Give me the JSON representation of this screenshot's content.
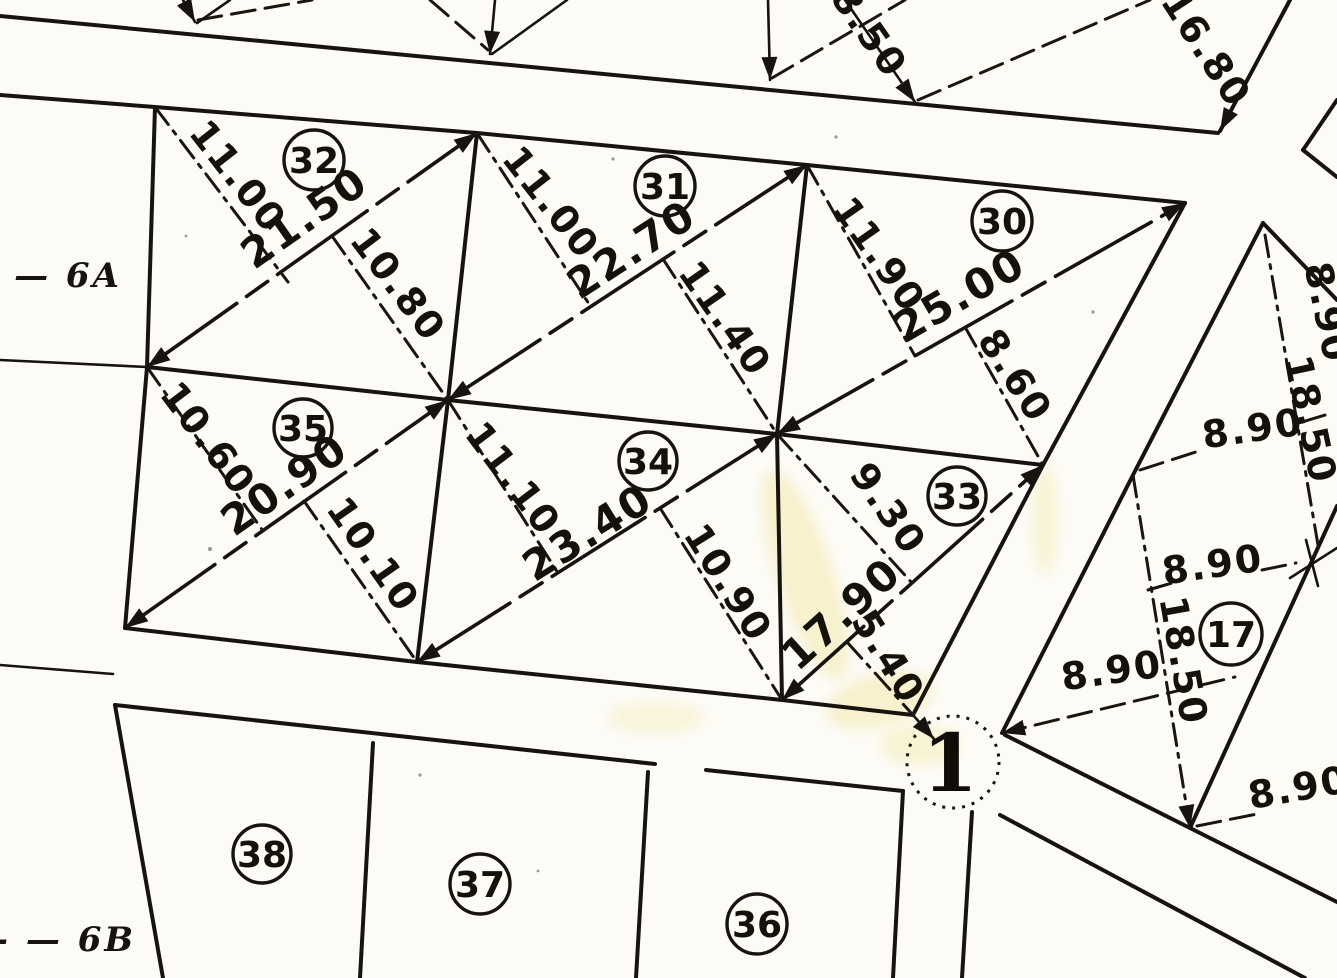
{
  "parcels": {
    "p32": {
      "label": "32",
      "h_left": "11.00",
      "base": "21.50",
      "h_right": "10.80"
    },
    "p31": {
      "label": "31",
      "h_left": "11.00",
      "base": "22.70",
      "h_right": "11.40"
    },
    "p30": {
      "label": "30",
      "h_left": "11.90",
      "base": "25.00",
      "h_right": "8.60"
    },
    "p35": {
      "label": "35",
      "h_left": "10.60",
      "base": "20.90",
      "h_right": "10.10"
    },
    "p34": {
      "label": "34",
      "h_left": "11.10",
      "base": "23.40",
      "h_right": "10.90"
    },
    "p33": {
      "label": "33",
      "h_left": "9.30",
      "base": "17.90",
      "h_right": "5.40"
    },
    "p17": {
      "label": "17"
    },
    "p38": {
      "label": "38"
    },
    "p37": {
      "label": "37"
    },
    "p36": {
      "label": "36"
    }
  },
  "junction": {
    "label": "1"
  },
  "top_margin": {
    "dim1": "8.50",
    "dim2": "16.80"
  },
  "right_block": {
    "dim_top_clipped": "8.90",
    "diag_upper": "18.50",
    "dim_upper": "8.90",
    "dim_mid": "8.90",
    "diag_lower": "18.50",
    "dim_left": "8.90",
    "dim_bottom": "8.90"
  },
  "margin_notes": {
    "upper": "— 6A",
    "lower": "- — 6B"
  }
}
